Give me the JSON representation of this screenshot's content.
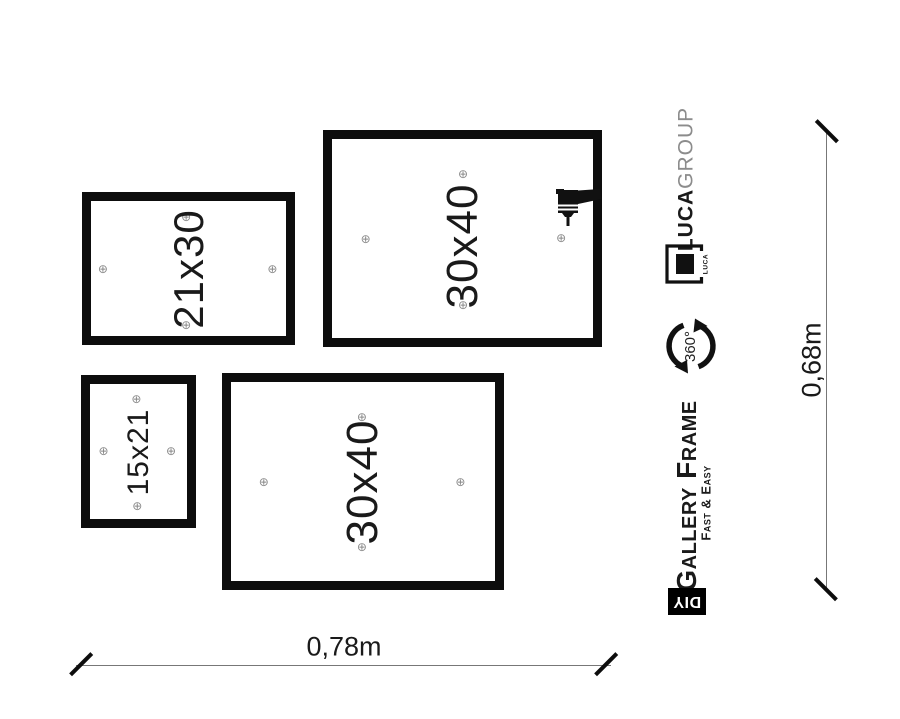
{
  "frames": [
    {
      "name": "frame-21x30",
      "label": "21x30"
    },
    {
      "name": "frame-30x40-top",
      "label": "30x40"
    },
    {
      "name": "frame-15x21",
      "label": "15x21"
    },
    {
      "name": "frame-30x40-bottom",
      "label": "30x40"
    }
  ],
  "glyphs": {
    "drill_point_marker": "⊕"
  },
  "branding": {
    "company_bold": "LUCA",
    "company_light": "GROUP",
    "logo_text": "LUCA",
    "rotation_label": "360°",
    "product_title": "Gallery Frame",
    "product_subtitle": "Fast & Easy",
    "diy_label": "DIY"
  },
  "dimensions": {
    "width_label": "0,78m",
    "height_label": "0,68m"
  },
  "colors": {
    "frame_border": "#0d0d0d",
    "marker": "#8a8a8a",
    "brand_gray": "#8c8c8c",
    "ink": "#111111",
    "badge_bg": "#000000",
    "badge_text": "#ffffff"
  }
}
